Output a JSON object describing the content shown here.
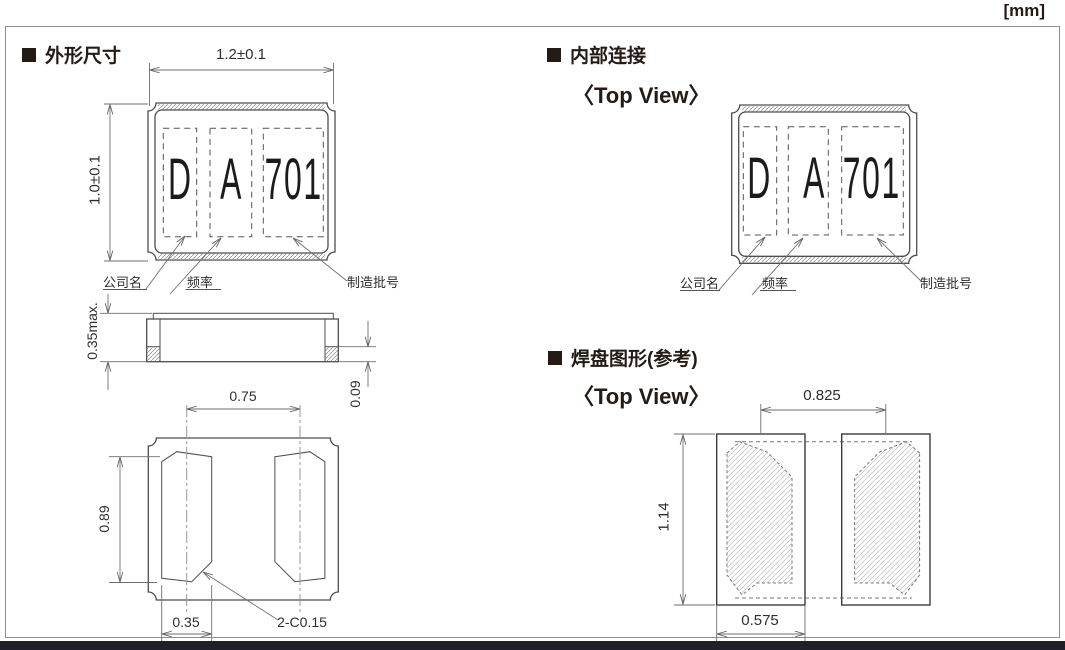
{
  "units_label": "[mm]",
  "marking": {
    "company_code": "D",
    "frequency_code": "A",
    "lot_code": "701"
  },
  "marking_labels": {
    "company": "公司名",
    "frequency": "频率",
    "lot": "制造批号"
  },
  "sections": {
    "outline": {
      "title": "外形尺寸",
      "dims": {
        "body_width": "1.2±0.1",
        "body_height": "1.0±0.1",
        "height_max": "0.35max.",
        "terminal_thickness": "0.09",
        "terminal_pitch": "0.75",
        "terminal_length": "0.89",
        "terminal_width": "0.35",
        "corner_chamfer": "2-C0.15"
      }
    },
    "internal": {
      "title": "内部连接",
      "view_label": "〈Top View〉"
    },
    "land": {
      "title": "焊盘图形(参考)",
      "view_label": "〈Top View〉",
      "dims": {
        "pad_pitch": "0.825",
        "pad_height": "1.14",
        "pad_width": "0.575"
      }
    }
  },
  "colors": {
    "ink": "#241b17",
    "line": "#4d4d4d",
    "dim_line": "#6e6e6e",
    "hatch": "#9a9a9a",
    "footer_bar": "#20202a",
    "border": "#8e8e8e",
    "background": "#ffffff"
  }
}
